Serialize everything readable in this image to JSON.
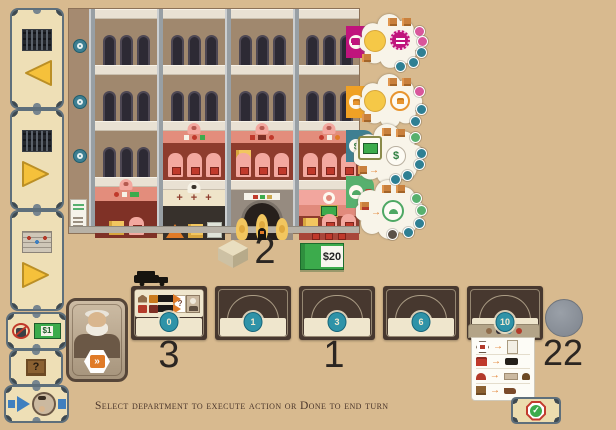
{
  "icons": {
    "question_mark": "?",
    "dollar": "$",
    "check": "✓",
    "double_chevron": "»",
    "arrow_right": "→",
    "plus": "+"
  },
  "colors": {
    "background": "#d8ba8f",
    "floor_tab_colors": [
      "#c0147c",
      "#f0a125",
      "#3e7f92",
      "#57b06e"
    ],
    "department_badge_teal": "#2f93a8",
    "money_green": "#3cab4c",
    "crate_yellow": "#f2c65f",
    "shop_pink": "#f3a89f",
    "card_brown": "#47382f"
  },
  "sidebar": {
    "arrow_cards": [
      {
        "direction": "left"
      },
      {
        "direction": "right"
      },
      {
        "direction": "right"
      }
    ],
    "wage_card": {
      "value": "$1"
    },
    "mystery_crate_card": {
      "label": "?"
    },
    "turn_order_card": {}
  },
  "building": {
    "floors": 4,
    "columns": 4,
    "action_tiles": [
      {
        "row": 1,
        "color": "#c0147c",
        "icon": "bed-icon"
      },
      {
        "row": 2,
        "color": "#f0a125",
        "icon": "armchair-icon"
      },
      {
        "row": 3,
        "color": "#3e7f92",
        "icon": "banknote-icon",
        "symbol": "$"
      },
      {
        "row": 4,
        "color": "#57b06e",
        "icon": "awning-icon"
      }
    ]
  },
  "supply": {
    "cube_count": "2",
    "money": "$20"
  },
  "departments": {
    "cards": [
      {
        "level": "0"
      },
      {
        "level": "1"
      },
      {
        "level": "3"
      },
      {
        "level": "6"
      },
      {
        "level": "10"
      }
    ],
    "count_left": "3",
    "count_middle": "1"
  },
  "round_track": {
    "disc_count": "22"
  },
  "status_bar": {
    "message": "Select department to execute action or Done to end turn"
  }
}
